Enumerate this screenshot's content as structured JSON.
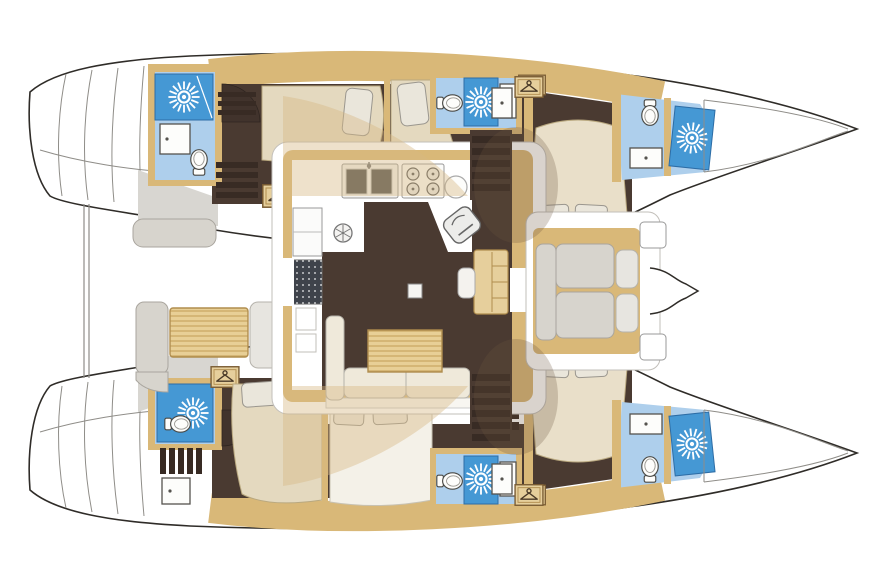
{
  "app": {
    "title": "Catamaran yacht deck plan — 6 cabin / 6 bathroom layout",
    "view": "top-down floor plan",
    "orientation": "bow to the right, twin hulls top and bottom"
  },
  "palette": {
    "outline": "#2f2c28",
    "deck_line": "#c2bfba",
    "tan_wall": "#d9b878",
    "tan_light": "#e6cf9c",
    "wood_table": "#e8cf96",
    "wood_stripe": "#c9a661",
    "floor_dark": "#4a3a31",
    "step_dark": "#382b24",
    "bed_beige": "#e4d9bf",
    "pillow": "#eae6db",
    "cushion_gray": "#d7d4cd",
    "sofa_cream": "#efe9da",
    "bath_floor": "#aecfec",
    "shower_blue": "#4598d4",
    "fixture_white": "#fdfdfb",
    "fixture_stroke": "#55534e",
    "deck_gray": "#d8d6d1",
    "appliance_dark": "#4e4e4c",
    "mat_dark": "#3f434b",
    "overlay_beige": "rgba(214,183,132,0.42)",
    "overlay_brown": "rgba(110,85,60,0.26)"
  },
  "boat": {
    "hulls": {
      "port": {
        "label": "Port hull (top)",
        "rooms": [
          {
            "label": "Aft bathroom",
            "fixtures": [
              "shower-sunburst",
              "vanity-sink",
              "toilet"
            ]
          },
          {
            "label": "Aft cabin",
            "fixtures": [
              "bed",
              "pillow",
              "wardrobe",
              "wardrobe",
              "stairs",
              "door"
            ]
          },
          {
            "label": "Mid cabin",
            "fixtures": [
              "bed",
              "pillow"
            ]
          },
          {
            "label": "Mid bathroom",
            "fixtures": [
              "toilet",
              "shower-sunburst",
              "vanity-sink",
              "wardrobe"
            ]
          },
          {
            "label": "Forward island-bed cabin",
            "fixtures": [
              "bed",
              "pillow",
              "pillow",
              "drawer-steps",
              "locker"
            ]
          },
          {
            "label": "Bow bathroom",
            "fixtures": [
              "toilet",
              "shower-sunburst",
              "vanity-sink"
            ]
          }
        ]
      },
      "starboard": {
        "label": "Starboard hull (bottom)",
        "rooms": [
          {
            "label": "Aft bathroom",
            "fixtures": [
              "shower-sunburst",
              "toilet",
              "stairs",
              "vanity-sink"
            ]
          },
          {
            "label": "Aft cabin",
            "fixtures": [
              "bed",
              "pillow",
              "wardrobe",
              "door"
            ]
          },
          {
            "label": "Mid cabin",
            "fixtures": [
              "bed",
              "pillow",
              "pillow"
            ]
          },
          {
            "label": "Mid bathroom",
            "fixtures": [
              "toilet",
              "shower-sunburst",
              "vanity-sink",
              "wardrobe"
            ]
          },
          {
            "label": "Forward island-bed cabin",
            "fixtures": [
              "bed",
              "pillow",
              "pillow",
              "drawer-steps",
              "locker"
            ]
          },
          {
            "label": "Bow bathroom",
            "fixtures": [
              "toilet",
              "shower-sunburst",
              "vanity-sink"
            ]
          }
        ]
      }
    },
    "saloon": {
      "label": "Main saloon and galley",
      "galley": {
        "label": "U-shaped galley",
        "fixtures": [
          "double-sink",
          "faucet",
          "stove-4-burner",
          "round-sink",
          "oven",
          "extractor-fan",
          "fridge",
          "vent-mat"
        ]
      },
      "nav": {
        "label": "Chart table with seat"
      },
      "lounge": {
        "label": "L-sofa with wood dining table"
      },
      "mast_post": {
        "label": "Mast compression post"
      }
    },
    "aft_cockpit": {
      "label": "Aft cockpit",
      "fixtures": [
        "bench",
        "cockpit-table",
        "side-bench",
        "side-bench",
        "davit-lines",
        "transom-steps",
        "transom-steps"
      ]
    },
    "fwd_cockpit": {
      "label": "Forward cockpit lounge",
      "fixtures": [
        "u-sofa",
        "locker-step",
        "locker-step",
        "bow-bracket"
      ]
    }
  },
  "legend": {
    "shower_icon": "white sunburst on blue shower pan",
    "toilet_icon": "toilet bowl with tank",
    "wardrobe_icon": "clothes hanger in wood locker",
    "stairs_icon": "slatted steps",
    "bathroom_color_note": "bathrooms shaded blue, floors dark brown, joinery tan"
  }
}
